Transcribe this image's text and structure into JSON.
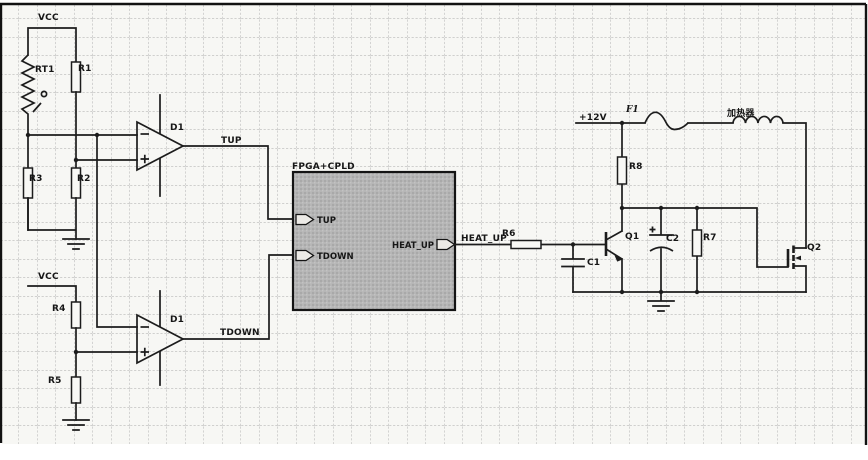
{
  "diagram": {
    "type": "circuit-schematic",
    "description": "Temperature control schematic: thermistor window comparators feeding an FPGA+CPLD that drives a heater power stage",
    "power_labels": {
      "vcc1": "VCC",
      "vcc2": "VCC",
      "v12": "+12V"
    },
    "components": {
      "rt1": "RT1",
      "r1": "R1",
      "r2": "R2",
      "r3": "R3",
      "r4": "R4",
      "r5": "R5",
      "comparator_top": "D1",
      "comparator_bottom": "D1",
      "r6": "R6",
      "c1": "C1",
      "q1": "Q1",
      "f1": "F1",
      "r8": "R8",
      "heater": "加热器",
      "c2": "C2",
      "r7": "R7",
      "q2": "Q2"
    },
    "nets": {
      "tup": "TUP",
      "tdown": "TDOWN",
      "heat_up": "HEAT_UP"
    },
    "fpga_block": {
      "title": "FPGA+CPLD",
      "pins": {
        "tup": "TUP",
        "tdown": "TDOWN",
        "heat_up": "HEAT_UP"
      }
    },
    "colors": {
      "ink": "#1c1c1c",
      "paper": "#f7f7f4",
      "grid": "#a8a8a8",
      "block_fill": "#b5b5b5"
    }
  }
}
